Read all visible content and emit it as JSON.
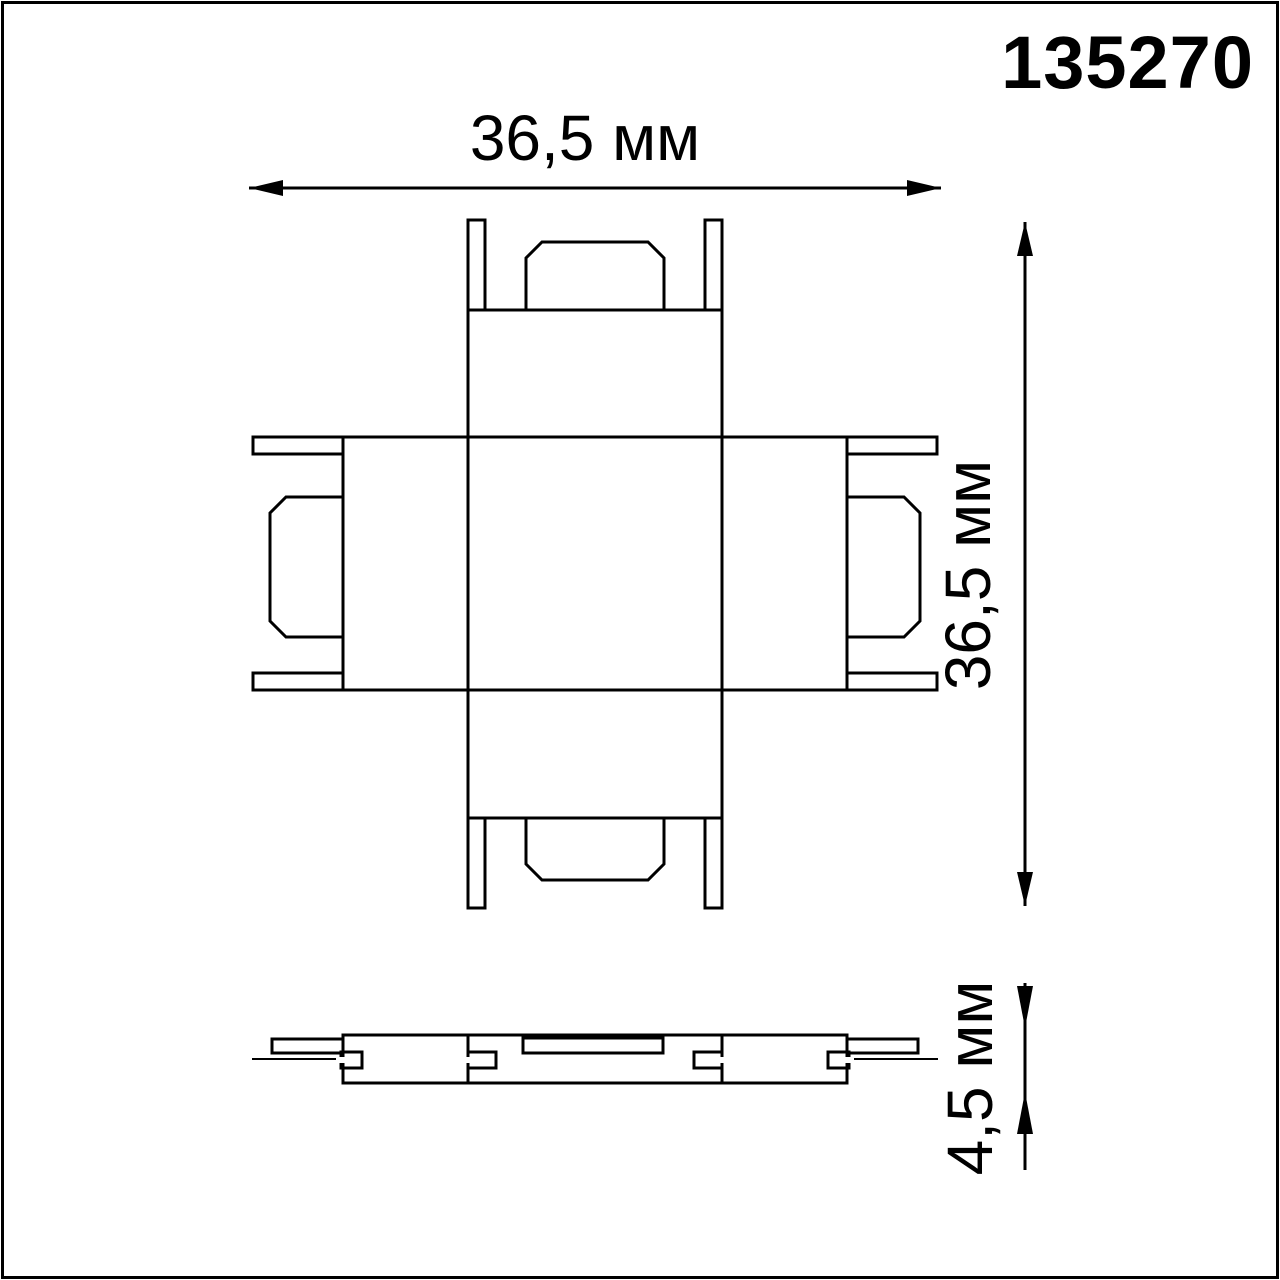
{
  "product_code": "135270",
  "dimensions": {
    "width_label": "36,5 мм",
    "height_label": "36,5 мм",
    "thickness_label": "4,5 мм"
  },
  "colors": {
    "line": "#000000",
    "background": "#ffffff"
  }
}
